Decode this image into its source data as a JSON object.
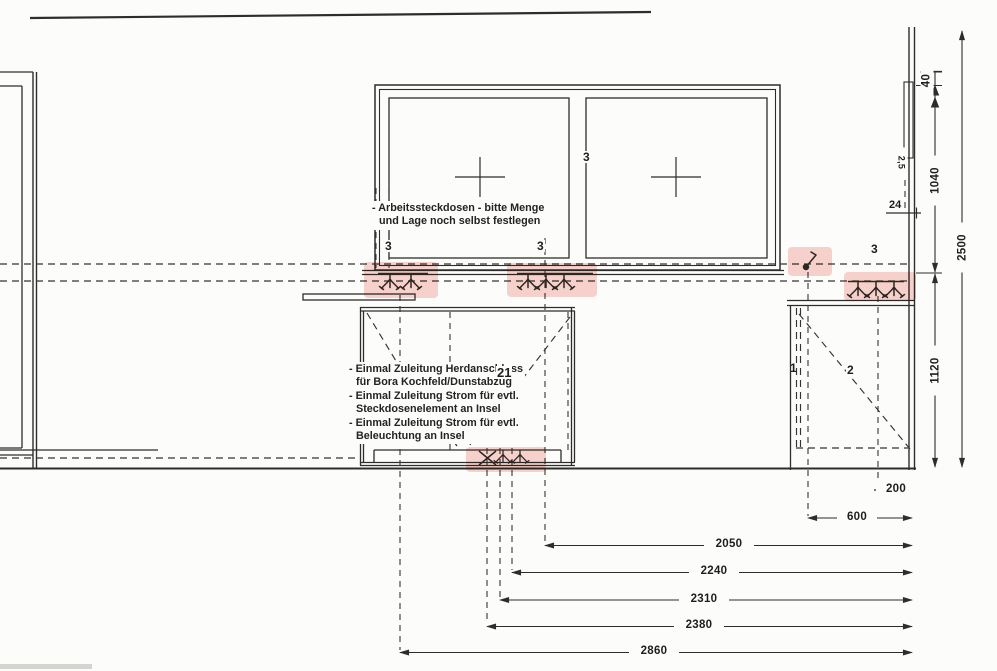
{
  "notes": {
    "arbeit": [
      "- Arbeitssteckdosen - bitte Menge",
      "und Lage noch selbst festlegen"
    ],
    "zuleitung": [
      "- Einmal Zuleitung Herdanschluss",
      "für Bora Kochfeld/Dunstabzug",
      "- Einmal Zuleitung Strom für evtl.",
      "Steckdosenelement an Insel",
      "- Einmal Zuleitung Strom für evtl.",
      "Beleuchtung an Insel"
    ]
  },
  "labels": {
    "mullion": "3",
    "group_left": "3",
    "group_center": "3",
    "group_right": "3",
    "cab1": "1",
    "cab2": "2",
    "island_diag": "21",
    "niche": "24",
    "cable": "2,5"
  },
  "dims": {
    "v40": "40",
    "v1040": "1040",
    "v1120": "1120",
    "v2500": "2500",
    "h200": "200",
    "h600": "600",
    "h2050": "2050",
    "h2240": "2240",
    "h2310": "2310",
    "h2380": "2380",
    "h2860": "2860"
  },
  "icons": {
    "socket": "steckdose-double-socket-symbol",
    "switch": "lichtschalter-switch-symbol",
    "stove": "herdanschluss-x-symbol",
    "arrow": "dimension-arrowhead"
  },
  "colors": {
    "line": "#2e2d2b",
    "highlight": "#ef8b7f",
    "paper": "#fcfcfa"
  }
}
